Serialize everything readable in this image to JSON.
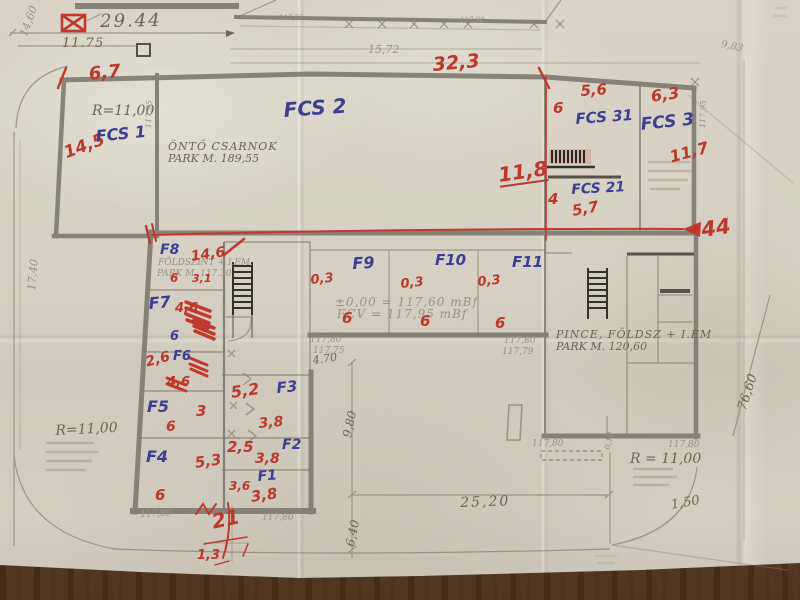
{
  "colors": {
    "red_pen": "#bc382b",
    "blue_pen": "#3c3e91",
    "pencil": "#6c6557",
    "wall_gray": "#7d7970",
    "paper": "#d6d1c4",
    "wood": "#5e402a"
  },
  "labels": {
    "dim_2944": "29.44",
    "dim_1175": "11.75",
    "dim_1460": "14,60",
    "dim_1740": "17,40",
    "dim_1572": "15,72",
    "dim_983": "9,83",
    "elev_a": "117,95",
    "elev_b": "117,98",
    "r67": "6,7",
    "r145": "14,5",
    "r323": "32,3",
    "r_left": "R=11,00",
    "fcs1": "FCS 1",
    "fcs2": "FCS 2",
    "fcs31": "FCS 31",
    "fcs3": "FCS 3",
    "fcs21": "FCS 21",
    "onto1": "ÖNTŐ CSARNOK",
    "onto2": "PARK M. 189,55",
    "r56": "5,6",
    "r63": "6,3",
    "r6_fcs": "6",
    "r118": "11,8",
    "r117": "11,7",
    "r4": "4",
    "r57": "5,7",
    "wall_elev_l": "117,95",
    "wall_elev_r": "117,95",
    "r44": "44",
    "f8": "F8",
    "f7": "F7",
    "f6": "F6",
    "f5": "F5",
    "f4": "F4",
    "f3": "F3",
    "f2": "F2",
    "f1": "F1",
    "f9": "F9",
    "f10": "F10",
    "f11": "F11",
    "foldszint1": "FÖLDSZINT + I.EM.",
    "foldszint2": "PARK M. 117,30",
    "r146": "14,6",
    "r6_f8": "6",
    "r31": "3,1",
    "r46": "4,6",
    "b6_f7": "6",
    "r26": "2,6",
    "r46b": "4,6",
    "r3": "3",
    "r6_f5": "6",
    "r53": "5,3",
    "r6_f4": "6",
    "r52": "5,2",
    "r38a": "3,8",
    "r25": "2,5",
    "r38b": "3,8",
    "r36": "3,6",
    "r38c": "3,8",
    "r21": "21",
    "r13": "1,3",
    "r03a": "0,3",
    "r03b": "0,3",
    "r03c": "0,3",
    "r6_f9": "6",
    "r6_f10": "6",
    "r6_f11": "6",
    "elev_line1": "±0,00 = 117,60 mBf",
    "elev_line2": "FCV = 117,95 mBf",
    "w11780a": "117,80",
    "w11775": "117,75",
    "w11780b": "117,80",
    "w11779": "117,79",
    "w11780c": "117,80",
    "w11780d": "117,80",
    "w11780e": "117,80",
    "w11780f": "117,80",
    "pince1": "PINCE, FÖLDSZ + I.EM",
    "pince2": "PARK M. 120,60",
    "r_right": "R = 11,00",
    "r_site": "R=11,00",
    "d470": "4.70",
    "d980": "9,80",
    "d640": "6,40",
    "d2520": "25,20",
    "d150": "1,50",
    "d7660": "76,60",
    "d010": "0,10"
  }
}
